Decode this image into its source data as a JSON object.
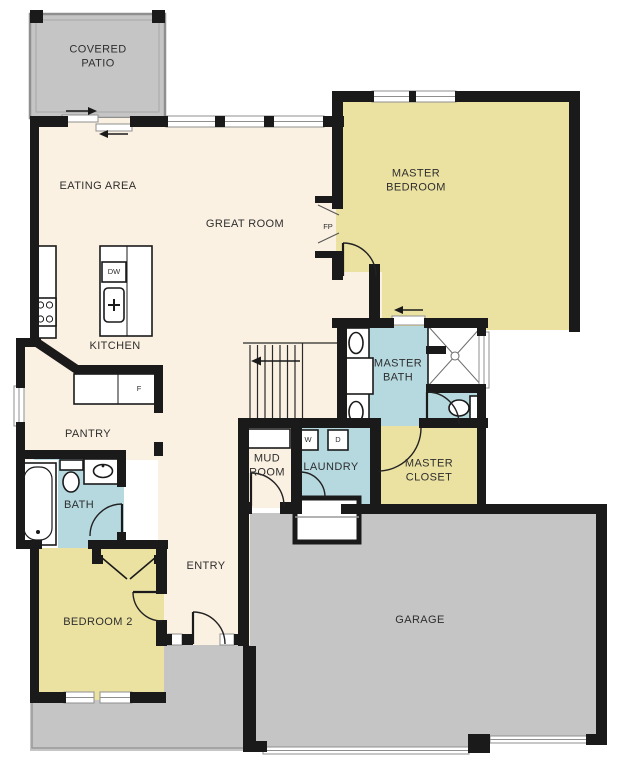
{
  "rooms": {
    "covered_patio": {
      "label": "COVERED PATIO"
    },
    "eating_area": {
      "label": "EATING AREA"
    },
    "great_room": {
      "label": "GREAT ROOM"
    },
    "master_bedroom": {
      "label": "MASTER BEDROOM"
    },
    "kitchen": {
      "label": "KITCHEN"
    },
    "master_bath": {
      "label": "MASTER BATH"
    },
    "pantry": {
      "label": "PANTRY"
    },
    "mud_room": {
      "label": "MUD ROOM"
    },
    "laundry": {
      "label": "LAUNDRY"
    },
    "master_closet": {
      "label": "MASTER CLOSET"
    },
    "bath": {
      "label": "BATH"
    },
    "bedroom_2": {
      "label": "BEDROOM 2"
    },
    "entry": {
      "label": "ENTRY"
    },
    "garage": {
      "label": "GARAGE"
    }
  },
  "fixtures": {
    "dishwasher": "DW",
    "fridge": "F",
    "washer": "W",
    "dryer": "D",
    "fireplace": "FP"
  },
  "colors": {
    "living": "#fbf1e2",
    "bedroom": "#ebe1a1",
    "bath": "#b6d9e0",
    "outdoor": "#c5c5c5",
    "wall": "#1a1a1a",
    "label_text": "#2e2e2e"
  }
}
